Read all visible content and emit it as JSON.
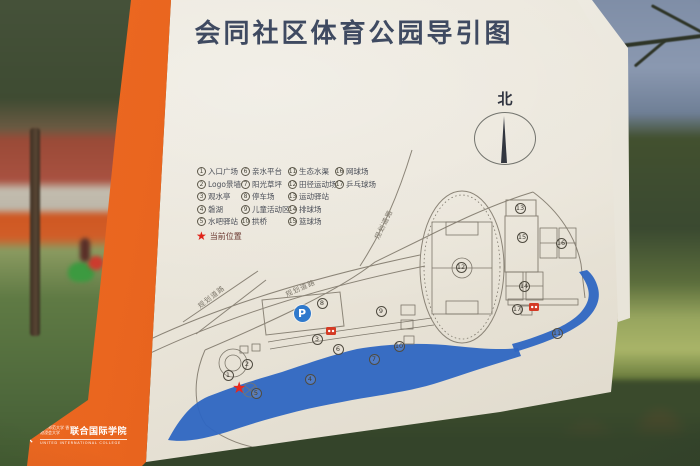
{
  "sign": {
    "title": "会同社区体育公园导引图",
    "north_label": "北",
    "legend": {
      "columns": [
        {
          "items": [
            {
              "num": "1",
              "label": "入口广场"
            },
            {
              "num": "2",
              "label": "Logo景墙"
            },
            {
              "num": "3",
              "label": "观水亭"
            },
            {
              "num": "4",
              "label": "磐湖"
            },
            {
              "num": "5",
              "label": "水吧驿站"
            }
          ]
        },
        {
          "items": [
            {
              "num": "6",
              "label": "亲水平台"
            },
            {
              "num": "7",
              "label": "阳光草坪"
            },
            {
              "num": "8",
              "label": "停车场"
            },
            {
              "num": "9",
              "label": "儿童活动区"
            },
            {
              "num": "10",
              "label": "拱桥"
            }
          ]
        },
        {
          "items": [
            {
              "num": "11",
              "label": "生态水渠"
            },
            {
              "num": "12",
              "label": "田径运动场"
            },
            {
              "num": "13",
              "label": "运动驿站"
            },
            {
              "num": "14",
              "label": "排球场"
            },
            {
              "num": "15",
              "label": "篮球场"
            }
          ]
        },
        {
          "items": [
            {
              "num": "16",
              "label": "网球场"
            },
            {
              "num": "17",
              "label": "乒乓球场"
            }
          ]
        }
      ],
      "current_location": {
        "icon_char": "★",
        "label": "当前位置"
      }
    },
    "road_labels": [
      "规划道路",
      "规划道路",
      "规划道路"
    ],
    "map": {
      "markers": [
        {
          "num": "1",
          "x": 228,
          "y": 375
        },
        {
          "num": "2",
          "x": 247,
          "y": 364
        },
        {
          "num": "3",
          "x": 317,
          "y": 339
        },
        {
          "num": "4",
          "x": 310,
          "y": 379
        },
        {
          "num": "5",
          "x": 256,
          "y": 393
        },
        {
          "num": "6",
          "x": 338,
          "y": 349
        },
        {
          "num": "7",
          "x": 374,
          "y": 359
        },
        {
          "num": "8",
          "x": 322,
          "y": 303
        },
        {
          "num": "9",
          "x": 381,
          "y": 311
        },
        {
          "num": "10",
          "x": 399,
          "y": 346
        },
        {
          "num": "11",
          "x": 557,
          "y": 333
        },
        {
          "num": "12",
          "x": 461,
          "y": 267
        },
        {
          "num": "13",
          "x": 520,
          "y": 208
        },
        {
          "num": "14",
          "x": 524,
          "y": 286
        },
        {
          "num": "15",
          "x": 522,
          "y": 237
        },
        {
          "num": "16",
          "x": 561,
          "y": 243
        },
        {
          "num": "17",
          "x": 517,
          "y": 309
        }
      ],
      "poi_icons": [
        {
          "name": "parking-icon",
          "type": "parking",
          "label": "P",
          "x": 302,
          "y": 313
        },
        {
          "name": "toilet-icon",
          "type": "toilet",
          "x": 331,
          "y": 331
        },
        {
          "name": "toilet-icon",
          "type": "toilet",
          "x": 534,
          "y": 307
        },
        {
          "name": "current-location-star",
          "type": "star",
          "icon_char": "★",
          "x": 240,
          "y": 388
        }
      ]
    },
    "logo": {
      "cn_small": "北京师范大学 香港浸会大学",
      "cn_large": "联合国际学院",
      "en": "UNITED INTERNATIONAL COLLEGE"
    },
    "colors": {
      "board_face": "#e9e4d8",
      "stripe_orange": "#e4601c",
      "lake_blue": "#2e66c2",
      "marker_red": "#e02318",
      "ink": "#3f4a61",
      "line": "#8b8477"
    }
  }
}
